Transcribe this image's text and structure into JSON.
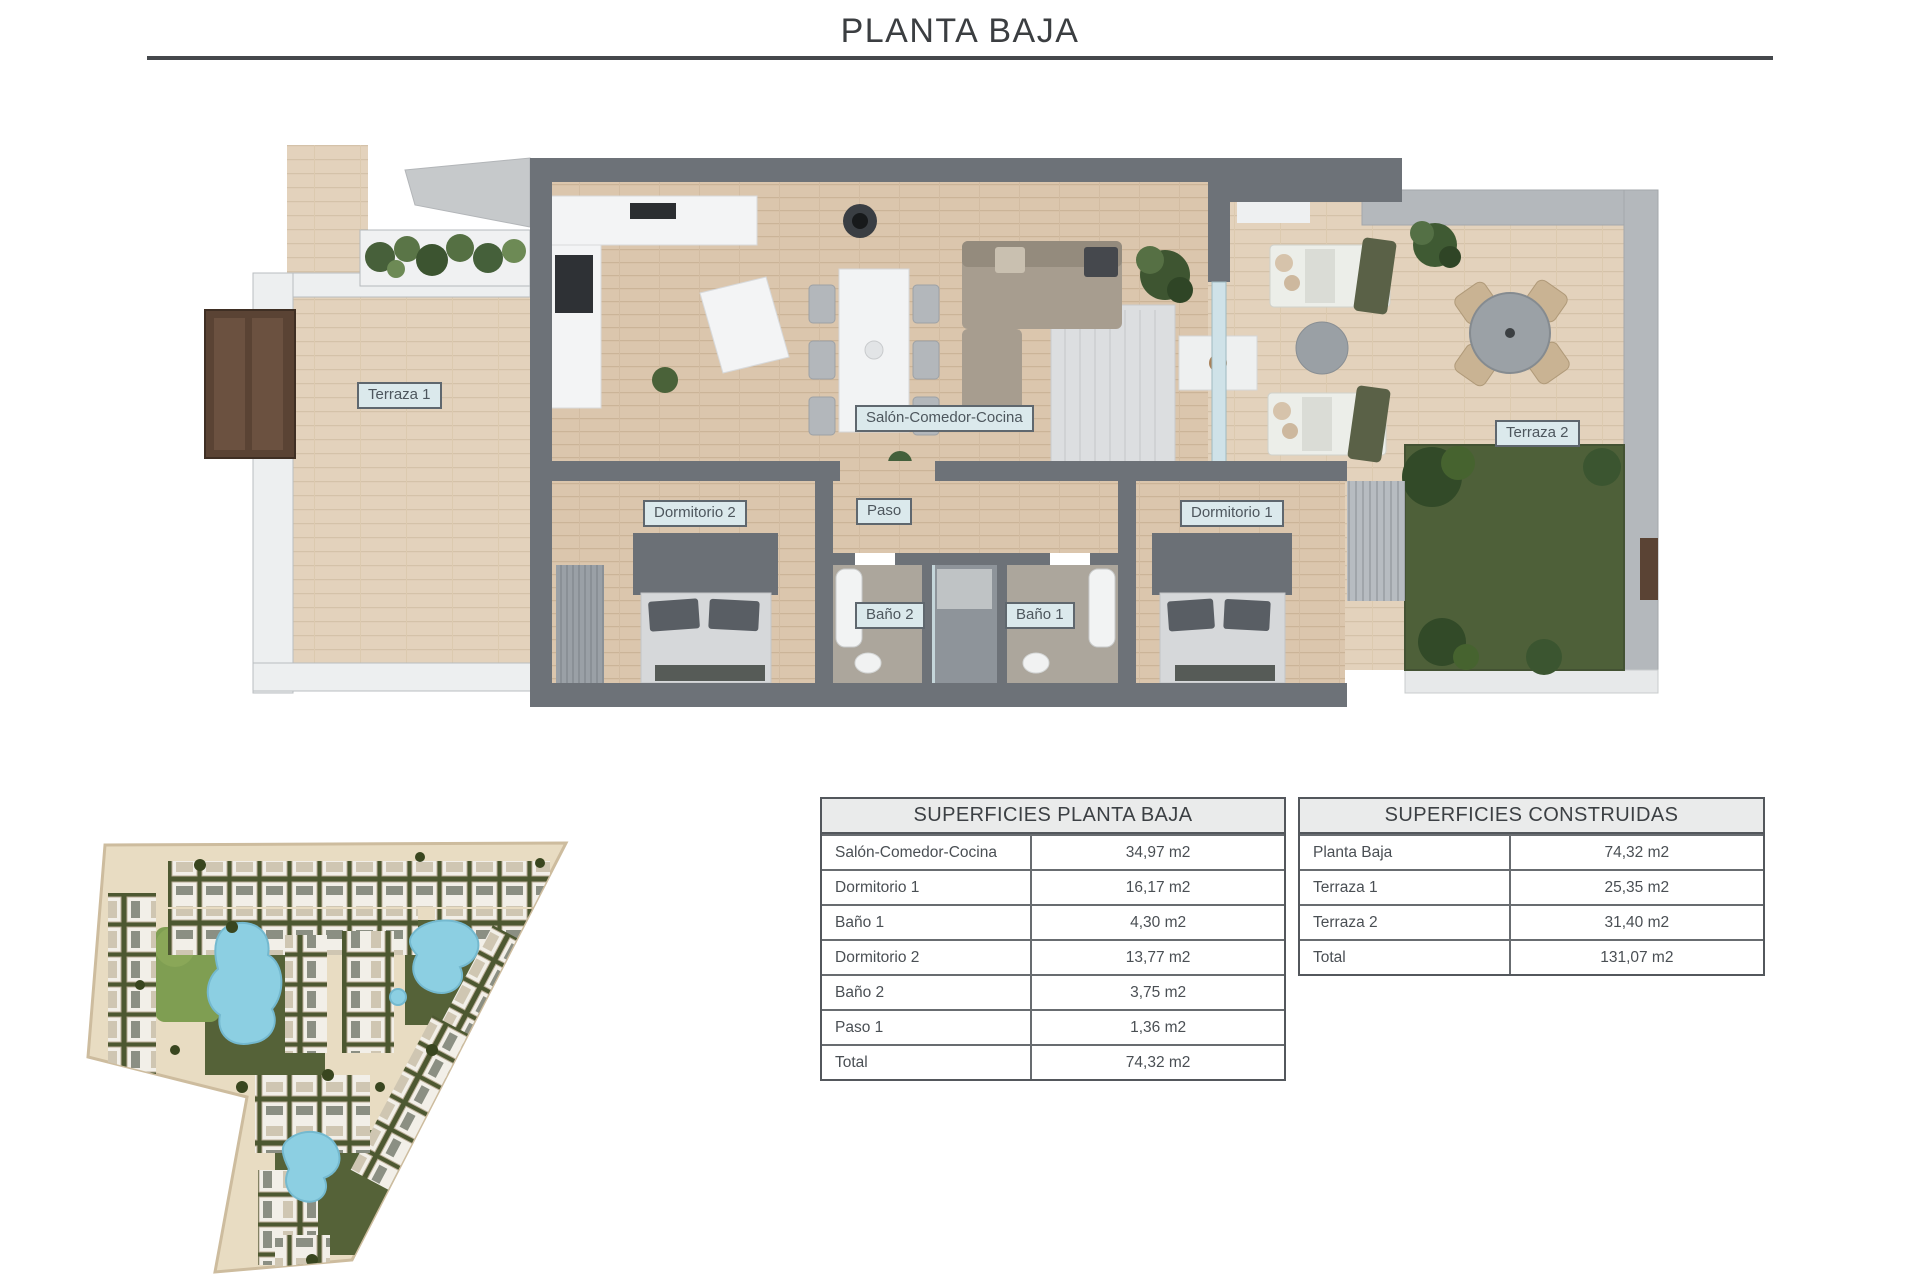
{
  "page_title": "PLANTA BAJA",
  "floor_plan": {
    "room_labels": [
      {
        "id": "terraza-1",
        "label": "Terraza 1"
      },
      {
        "id": "salon",
        "label": "Salón-Comedor-Cocina"
      },
      {
        "id": "dormitorio-2",
        "label": "Dormitorio 2"
      },
      {
        "id": "paso",
        "label": "Paso"
      },
      {
        "id": "bano-2",
        "label": "Baño 2"
      },
      {
        "id": "bano-1",
        "label": "Baño 1"
      },
      {
        "id": "dormitorio-1",
        "label": "Dormitorio 1"
      },
      {
        "id": "terraza-2",
        "label": "Terraza 2"
      }
    ]
  },
  "surface_tables": [
    {
      "title": "SUPERFICIES PLANTA BAJA",
      "rows": [
        {
          "name": "Salón-Comedor-Cocina",
          "area": "34,97 m2"
        },
        {
          "name": "Dormitorio 1",
          "area": "16,17 m2"
        },
        {
          "name": "Baño 1",
          "area": "4,30 m2"
        },
        {
          "name": "Dormitorio 2",
          "area": "13,77 m2"
        },
        {
          "name": "Baño 2",
          "area": "3,75 m2"
        },
        {
          "name": "Paso 1",
          "area": "1,36 m2"
        },
        {
          "name": "Total",
          "area": "74,32 m2"
        }
      ]
    },
    {
      "title": "SUPERFICIES CONSTRUIDAS",
      "rows": [
        {
          "name": "Planta Baja",
          "area": "74,32 m2"
        },
        {
          "name": "Terraza 1",
          "area": "25,35 m2"
        },
        {
          "name": "Terraza 2",
          "area": "31,40 m2"
        },
        {
          "name": "Total",
          "area": "131,07 m2"
        }
      ]
    }
  ],
  "colors": {
    "wood_floor": "#dbc6ad",
    "terrace_wood": "#e3d2bc",
    "wall_dark": "#6d7278",
    "wall_light": "#b4b8bc",
    "label_bg": "#dbe9ec",
    "grass": "#4e6039",
    "pool": "#8ccfe2",
    "site_base": "#e8dcc2",
    "rule": "#45484c"
  }
}
